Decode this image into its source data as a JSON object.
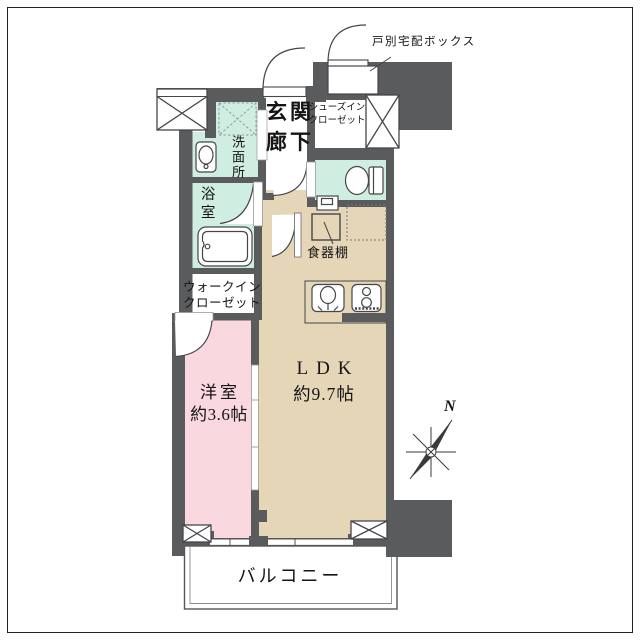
{
  "title": "1LDK apartment floor plan",
  "labels": {
    "delivery_box": "戸別宅配ボックス",
    "entrance": "玄関",
    "hallway": "廊下",
    "shoes_closet_line1": "シューズイン",
    "shoes_closet_line2": "クローゼット",
    "washroom": "洗面所",
    "bathroom": "浴室",
    "walk_in_closet_line1": "ウォークイン",
    "walk_in_closet_line2": "クローゼット",
    "western_room": "洋室",
    "western_room_size": "約3.6帖",
    "ldk": "LDK",
    "ldk_size": "約9.7帖",
    "cupboard": "食器棚",
    "balcony": "バルコニー",
    "compass_north": "N"
  },
  "rooms": [
    {
      "name": "LDK",
      "size": "約9.7帖",
      "color": "#e6d6b8"
    },
    {
      "name": "洋室",
      "size": "約3.6帖",
      "color": "#f9d8e0"
    },
    {
      "name": "浴室",
      "color": "#cfeee1"
    },
    {
      "name": "洗面所",
      "color": "#cfeee1"
    },
    {
      "name": "トイレ",
      "color": "#cfeee1"
    },
    {
      "name": "玄関・廊下",
      "color": "#ffffff"
    },
    {
      "name": "ウォークインクローゼット",
      "color": "#ffffff"
    },
    {
      "name": "シューズインクローゼット",
      "color": "#ffffff"
    },
    {
      "name": "バルコニー",
      "color": "#ffffff"
    }
  ],
  "colors": {
    "wall": "#5a5b5d",
    "mint": "#cfeee1",
    "pink": "#f9d8e0",
    "beige": "#e6d6b8",
    "line": "#45464a",
    "frame": "#222222"
  }
}
